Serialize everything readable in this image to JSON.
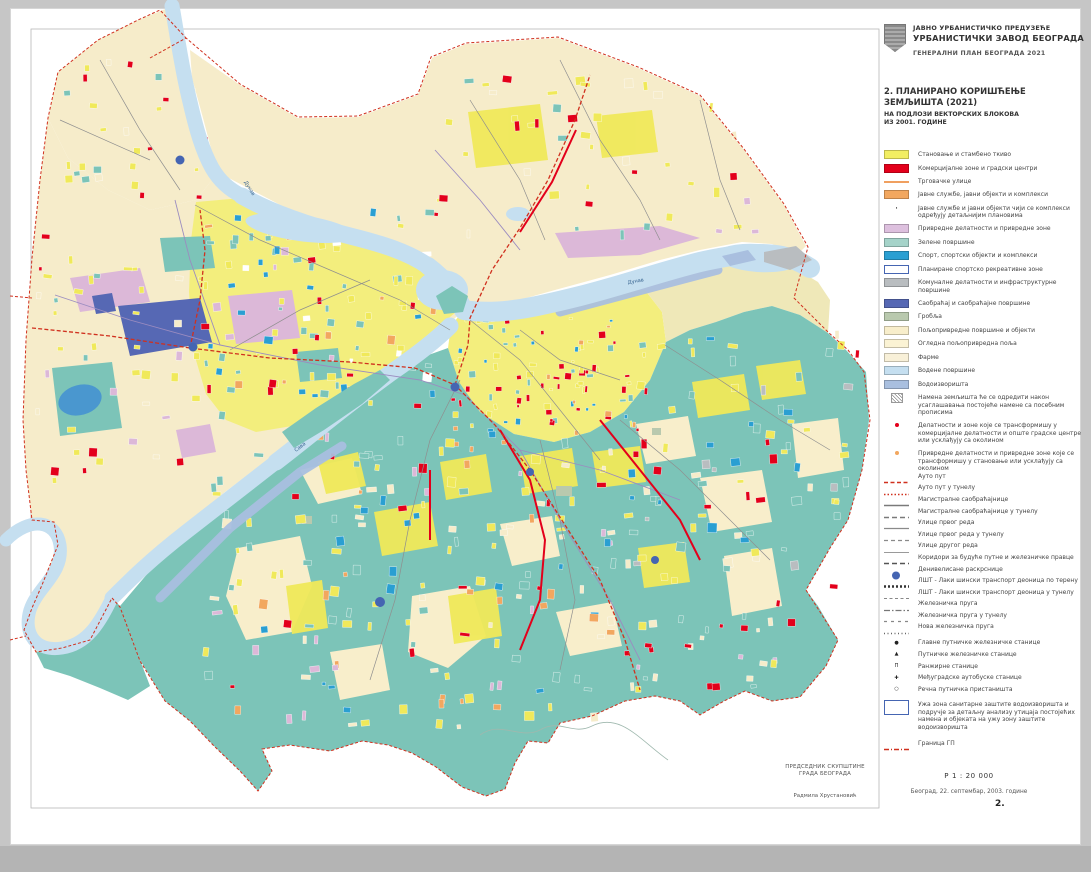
{
  "header": {
    "line1": "ЈАВНО УРБАНИСТИЧКО ПРЕДУЗЕЋЕ",
    "line2": "УРБАНИСТИЧКИ ЗАВОД БЕОГРАДА",
    "line3": "ГЕНЕРАЛНИ ПЛАН БЕОГРАДА 2021"
  },
  "title": {
    "line1": "2. ПЛАНИРАНО КОРИШЋЕЊЕ",
    "line2": "ЗЕМЉИШТА   (2021)",
    "sub1": "НА ПОДЛОЗИ ВЕКТОРСКИХ БЛОКОВА",
    "sub2": "ИЗ 2001. ГОДИНЕ"
  },
  "legend": {
    "areas": [
      {
        "color": "#f2ee62",
        "label": "Становање и стамбено ткиво"
      },
      {
        "color": "#e3001b",
        "label": "Комерцијалне зоне и градски центри"
      },
      {
        "type": "line",
        "color": "#f0a060",
        "label": "Трговачке улице"
      },
      {
        "color": "#f2a75f",
        "label": "Јавне службе, јавни објекти и комплекси"
      },
      {
        "type": "symbol",
        "symbol": "dot-gray",
        "label": "Јавне службе и јавни објекти чији се комплекси одређују детаљнијим плановима"
      },
      {
        "color": "#ddc0de",
        "label": "Привредне делатности и привредне зоне"
      },
      {
        "color": "#a5d3c9",
        "label": "Зелене површине"
      },
      {
        "color": "#2a9fd2",
        "label": "Спорт, спортски објекти и комплекси"
      },
      {
        "color": "#ffffff",
        "border": "#4565b2",
        "label": "Планиране спортско рекреативне зоне"
      },
      {
        "color": "#b9bdc0",
        "label": "Комуналне делатности и инфраструктурне површине"
      },
      {
        "color": "#5668b4",
        "label": "Саобраћај и саобраћајне површине"
      },
      {
        "color": "#b9c9ae",
        "label": "Гробља"
      },
      {
        "color": "#f8eecb",
        "label": "Пољопривредне површине и објекти"
      },
      {
        "color": "#fbf3d4",
        "label": "Огледна пољопривредна поља"
      },
      {
        "color": "#f8f0d8",
        "label": "Фарме"
      },
      {
        "color": "#c5dff0",
        "label": "Водене површине"
      },
      {
        "color": "#a9bfdf",
        "label": "Водоизворишта"
      }
    ],
    "notes": [
      {
        "symbol": "hatch",
        "label": "Намена земљишта ће се одредити након усаглашавања постојеће намене са посебним прописима"
      },
      {
        "symbol": "dot-red",
        "label": "Делатности и зоне које се трансформишу у комерцијалне делатности и опште градске центре или усклађују са околином"
      },
      {
        "symbol": "dot-orange",
        "label": "Привредне делатности и привредне зоне које се трансформишу у становање или усклађују са околином"
      }
    ],
    "lines": [
      {
        "style": "red-dash",
        "label": "Ауто пут"
      },
      {
        "style": "red-dot",
        "label": "Ауто пут у тунелу"
      },
      {
        "style": "solid-md",
        "label": "Магистралне саобраћајнице"
      },
      {
        "style": "dash-md",
        "label": "Магистралне саобраћајнице у тунелу"
      },
      {
        "style": "solid-sm",
        "label": "Улице првог реда"
      },
      {
        "style": "dash-sm",
        "label": "Улице првог реда у тунелу"
      },
      {
        "style": "solid-xs",
        "label": "Улице другог реда"
      },
      {
        "style": "dash-dark",
        "label": "Коридори за будуће путне и железничке правце"
      },
      {
        "style": "circle",
        "label": "Денивелисане раскрснице"
      },
      {
        "style": "bold-dot",
        "label": "ЛШТ -  Лаки шински транспорт деоница по терену"
      },
      {
        "style": "fine-dash",
        "label": "ЛШТ -  Лаки шински транспорт деоница у тунелу"
      },
      {
        "style": "dash-dot",
        "label": "Железничка пруга"
      },
      {
        "style": "spaced-dash",
        "label": "Железничка пруга у тунелу"
      },
      {
        "style": "dotted",
        "label": "Нова железничка пруга"
      }
    ],
    "stations": [
      {
        "glyph": "●",
        "label": "Главне путничке железничке станице"
      },
      {
        "glyph": "▲",
        "label": "Путничке железничке станице"
      },
      {
        "glyph": "П",
        "label": "Ранжирне станице"
      },
      {
        "glyph": "✚",
        "label": "Међуградске аутобуске станице"
      },
      {
        "glyph": "○",
        "label": "Речна путничка пристаништа"
      }
    ],
    "protection_box": {
      "label": "Ужа зона санитарне заштите водоизворишта и подручје за детаљну анализу утицаја постојећих намена и објеката на ужу зону заштите водоизворишта"
    },
    "boundary": {
      "style": "granica",
      "label": "Граница ГП"
    }
  },
  "footer": {
    "scale": "Р 1 : 20 000",
    "date": "Београд, 22. септембар, 2003. године",
    "page_number": "2."
  },
  "stamp": {
    "line1": "ПРЕДСЕДНИК СКУПШТИНЕ",
    "line2": "ГРАДА БЕОГРАДА",
    "name": "Радмила Хрустановић"
  },
  "map": {
    "labels": {
      "sava": "Сава",
      "dunav_upper": "Дунав",
      "dunav_lower": "Дунав"
    },
    "palette": {
      "housing": "#f0e95a",
      "housing_base": "#f3ee7d",
      "commercial": "#e3001b",
      "services": "#f2a75f",
      "industry": "#dcb8d8",
      "green": "#7cc4b8",
      "sport": "#2a9fd2",
      "utility": "#b9bdc0",
      "transport": "#5668b4",
      "cemetery": "#b9c9ae",
      "agriculture": "#f6ecca",
      "water": "#c5dff0",
      "water_source": "#a9bfdf",
      "lake": "#4a97cf",
      "boundary": "#d0301e",
      "road": "#8f8f8f",
      "rail": "#9b8cc0"
    }
  }
}
